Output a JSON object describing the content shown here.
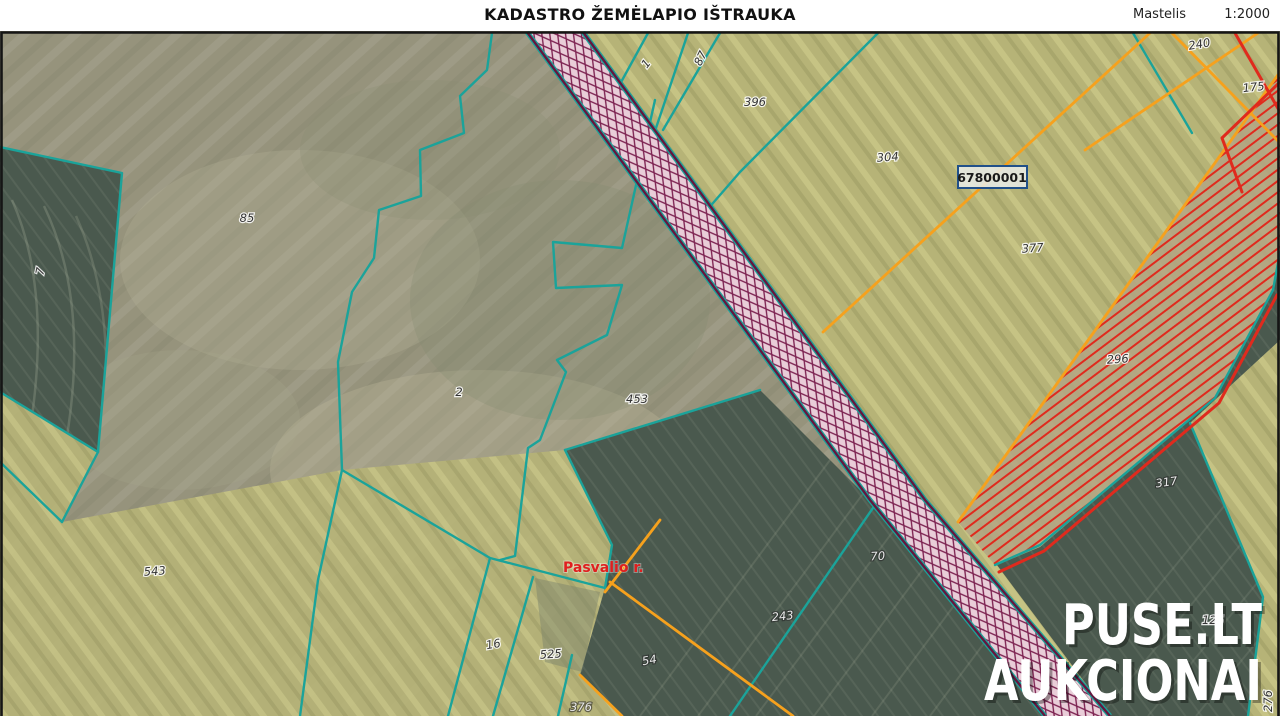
{
  "header": {
    "title": "KADASTRO ŽEMĖLAPIO IŠTRAUKA",
    "scale_label": "Mastelis",
    "scale_value": "1:2000"
  },
  "map": {
    "block_label": "67800001",
    "district_label": "Pasvalio r.",
    "watermark": {
      "line1": "PUSE.LT",
      "line2": "AUKCIONAI"
    },
    "parcel_labels": [
      {
        "text": "85",
        "x": 247,
        "y": 222,
        "rot": 0,
        "theme": "bright"
      },
      {
        "text": "7",
        "x": 44,
        "y": 272,
        "rot": -78,
        "theme": "bright"
      },
      {
        "text": "2",
        "x": 459,
        "y": 396,
        "rot": 0,
        "theme": "bright"
      },
      {
        "text": "453",
        "x": 637,
        "y": 403,
        "rot": 0,
        "theme": "bright"
      },
      {
        "text": "543",
        "x": 155,
        "y": 575,
        "rot": -4,
        "theme": "bright"
      },
      {
        "text": "16",
        "x": 494,
        "y": 648,
        "rot": -10,
        "theme": "bright"
      },
      {
        "text": "525",
        "x": 551,
        "y": 658,
        "rot": -4,
        "theme": "bright"
      },
      {
        "text": "1",
        "x": 649,
        "y": 66,
        "rot": -52,
        "theme": "bright"
      },
      {
        "text": "87",
        "x": 704,
        "y": 60,
        "rot": -64,
        "theme": "bright"
      },
      {
        "text": "396",
        "x": 755,
        "y": 106,
        "rot": 0,
        "theme": "bright"
      },
      {
        "text": "304",
        "x": 888,
        "y": 161,
        "rot": -4,
        "theme": "bright"
      },
      {
        "text": "377",
        "x": 1033,
        "y": 252,
        "rot": -4,
        "theme": "bright"
      },
      {
        "text": "240",
        "x": 1200,
        "y": 48,
        "rot": -10,
        "theme": "bright"
      },
      {
        "text": "175",
        "x": 1254,
        "y": 91,
        "rot": -6,
        "theme": "bright"
      },
      {
        "text": "296",
        "x": 1118,
        "y": 363,
        "rot": -4,
        "theme": "bright"
      },
      {
        "text": "125",
        "x": 1213,
        "y": 624,
        "rot": 0,
        "theme": "bright"
      },
      {
        "text": "276",
        "x": 1272,
        "y": 701,
        "rot": -90,
        "theme": "bright"
      },
      {
        "text": "70",
        "x": 878,
        "y": 560,
        "rot": -3,
        "theme": "dark"
      },
      {
        "text": "243",
        "x": 783,
        "y": 620,
        "rot": -6,
        "theme": "dark"
      },
      {
        "text": "54",
        "x": 650,
        "y": 664,
        "rot": -10,
        "theme": "dark"
      },
      {
        "text": "317",
        "x": 1167,
        "y": 486,
        "rot": -8,
        "theme": "dark"
      },
      {
        "text": "376",
        "x": 581,
        "y": 711,
        "rot": 0,
        "theme": "dark"
      }
    ],
    "colors": {
      "teal": "#1ba39a",
      "orange": "#f6a11d",
      "red": "#e02a1d",
      "road_fill": "#e9cdd8",
      "road_hatch": "#7c2150",
      "road_border": "#63183f",
      "dark_field": "#4a594e",
      "olive_field": "#96937c",
      "bright_field": "#b6b377",
      "tan_field": "#b3a584",
      "label_text": "#333333",
      "label_halo": "#ffffff",
      "dark_label_text": "#e9e9e9",
      "watermark": "#ffffff",
      "district_text": "#e01f1f",
      "block_border": "#215089",
      "frame": "#151515"
    }
  }
}
